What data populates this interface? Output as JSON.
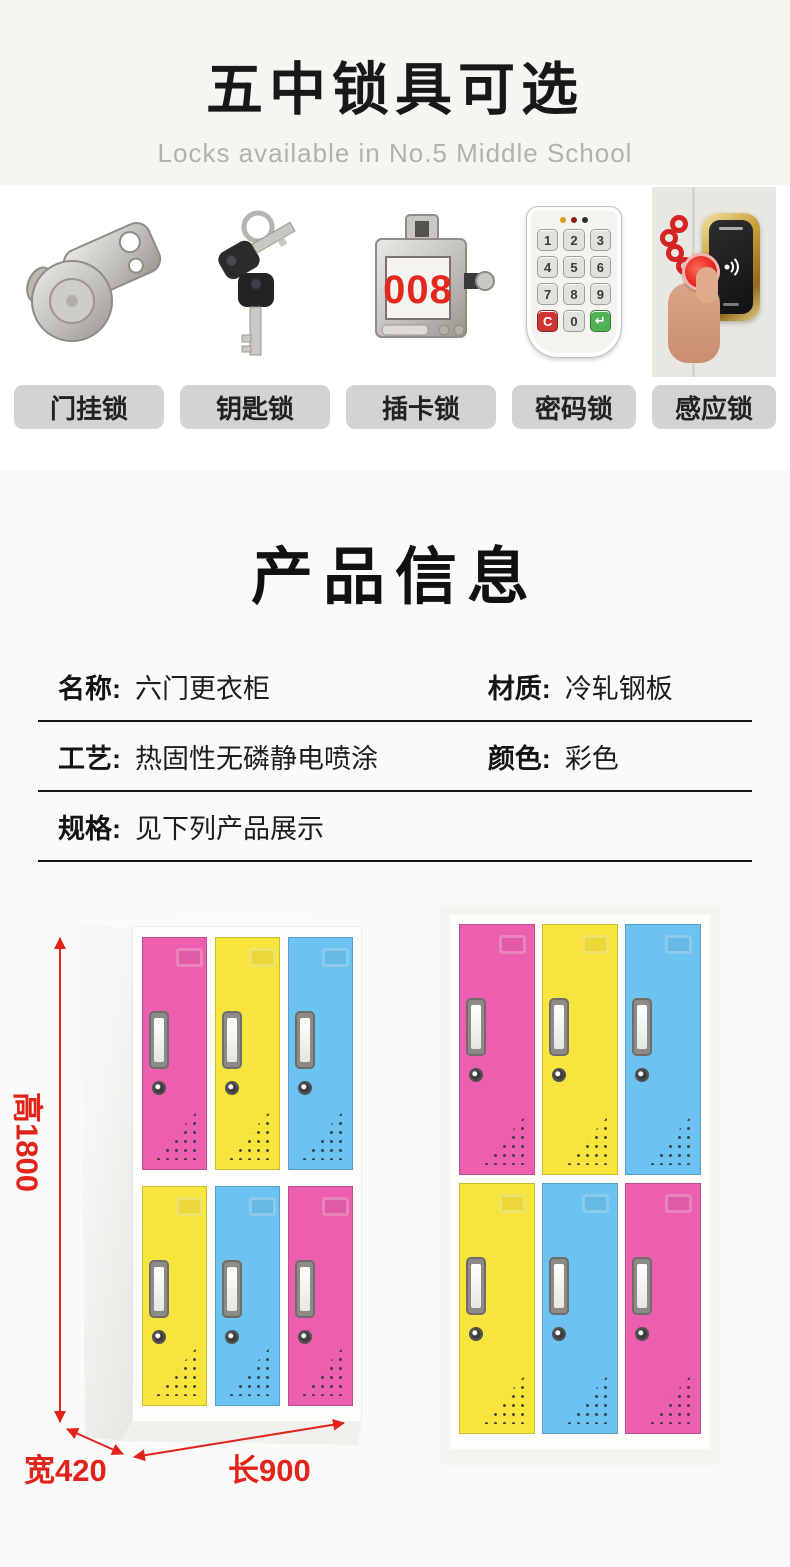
{
  "header": {
    "title": "五中锁具可选",
    "subtitle": "Locks available in No.5 Middle School"
  },
  "locks": {
    "items": [
      {
        "label": "门挂锁",
        "icon": "cam-lock-icon"
      },
      {
        "label": "钥匙锁",
        "icon": "keys-icon"
      },
      {
        "label": "插卡锁",
        "icon": "card-lock-icon",
        "number_display": "008"
      },
      {
        "label": "密码锁",
        "icon": "keypad-lock-icon",
        "keys": [
          "1",
          "2",
          "3",
          "4",
          "5",
          "6",
          "7",
          "8",
          "9",
          "C",
          "0",
          "↵"
        ]
      },
      {
        "label": "感应锁",
        "icon": "rfid-lock-icon"
      }
    ]
  },
  "product_info": {
    "section_title": "产品信息",
    "rows": [
      {
        "cells": [
          {
            "label": "名称:",
            "value": "六门更衣柜"
          },
          {
            "label": "材质:",
            "value": "冷轧钢板"
          }
        ]
      },
      {
        "cells": [
          {
            "label": "工艺:",
            "value": "热固性无磷静电喷涂"
          },
          {
            "label": "颜色:",
            "value": "彩色"
          }
        ]
      },
      {
        "cells": [
          {
            "label": "规格:",
            "value": "见下列产品展示"
          }
        ]
      }
    ]
  },
  "lockers": {
    "left": {
      "view": "perspective",
      "door_colors": [
        "pink",
        "yellow",
        "blue",
        "yellow",
        "blue",
        "pink"
      ]
    },
    "right": {
      "view": "front",
      "door_colors": [
        "pink",
        "yellow",
        "blue",
        "yellow",
        "blue",
        "pink"
      ]
    },
    "dimensions": {
      "height": "高1800",
      "width": "宽420",
      "length": "长900"
    }
  },
  "colors": {
    "pink": "#ec5fae",
    "yellow": "#f7e43c",
    "blue": "#6cc3f1",
    "dimension_red": "#e2231a",
    "display_red": "#e4281e",
    "label_chip_bg": "#d3d3d3",
    "header_bg": "#f5f5f2",
    "section_bg": "#fafaf8",
    "keypad_clear": "#cb3632",
    "keypad_enter": "#52b152"
  }
}
